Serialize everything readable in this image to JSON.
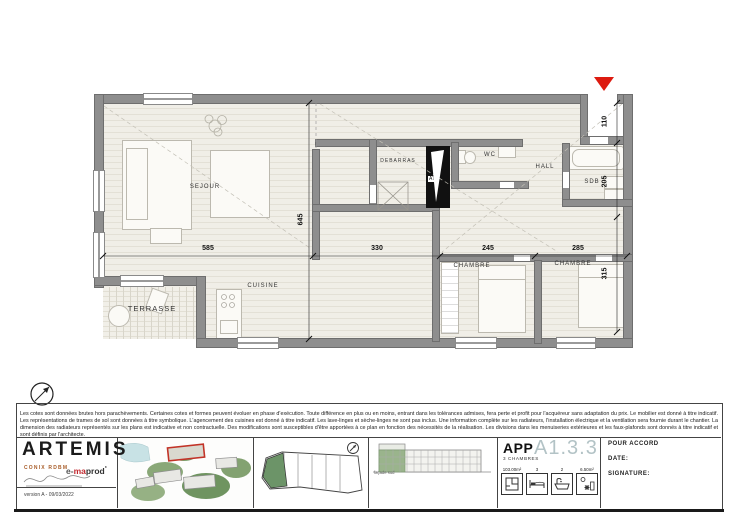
{
  "plan": {
    "labels": {
      "sejour": "SEJOUR",
      "debarras": "DEBARRAS",
      "wc": "WC",
      "hall": "HALL",
      "sdb": "SDB",
      "chambre1": "CHAMBRE",
      "chambre2": "CHAMBRE",
      "cuisine": "CUISINE",
      "terrasse": "TERRASSE",
      "shaft": "AT2"
    },
    "dims": {
      "h": [
        "585",
        "330",
        "245",
        "285"
      ],
      "v_left": "645",
      "v_right": [
        "110",
        "205",
        "315"
      ]
    }
  },
  "disclaimer": "Les cotes sont données brutes hors parachèvements. Certaines cotes et formes peuvent évoluer en phase d'exécution. Toute différence en plus ou en moins, entrant dans les tolérances admises, fera perte et profit pour l'acquéreur sans adaptation du prix. Le mobilier est donné à titre indicatif. Les représentations de trames de sol sont données à titre symbolique. L'agencement des cuisines est donné à titre indicatif. Les lave-linges et sèche-linges ne sont pas inclus. Une information complète sur les radiateurs, l'installation électrique et la ventilation sera fournie durant le chantier. La dimension des radiateurs représentés sur les plans est indicative et non contractuelle. Des modifications sont susceptibles d'être apportées à ce plan en fonction des nécessités de la réalisation. Les divisions dans les menuiseries extérieures et les faux-plafonds sont donnés à titre indicatif et sont définis par l'architecte.",
  "titleblock": {
    "brand": "ARTEMIS",
    "brand_sub": "CONIX RDBM",
    "producer": {
      "p1": "e-",
      "p2": "ma",
      "p3": "prod",
      "sup": "°"
    },
    "version": "version A - 09/03/2022",
    "facade_label": "façade sud",
    "apartment": {
      "type": "APP",
      "subtitle": "3 CHAMBRES",
      "code": "A1.3.3",
      "stats": [
        {
          "value": "103.00m²",
          "icon": "floorplan-icon"
        },
        {
          "value": "3",
          "icon": "bed-icon"
        },
        {
          "value": "2",
          "icon": "bath-icon"
        },
        {
          "value": "6.50m²",
          "icon": "terrace-icon"
        }
      ]
    },
    "approval": {
      "accord": "POUR ACCORD",
      "date": "DATE:",
      "signature": "SIGNATURE:"
    }
  },
  "colors": {
    "accent_red": "#dd1b10",
    "unit_green": "#6c9468",
    "code_gray": "#b3c3c6",
    "brand_red": "#c0272d",
    "conix_orange": "#a85c28"
  }
}
